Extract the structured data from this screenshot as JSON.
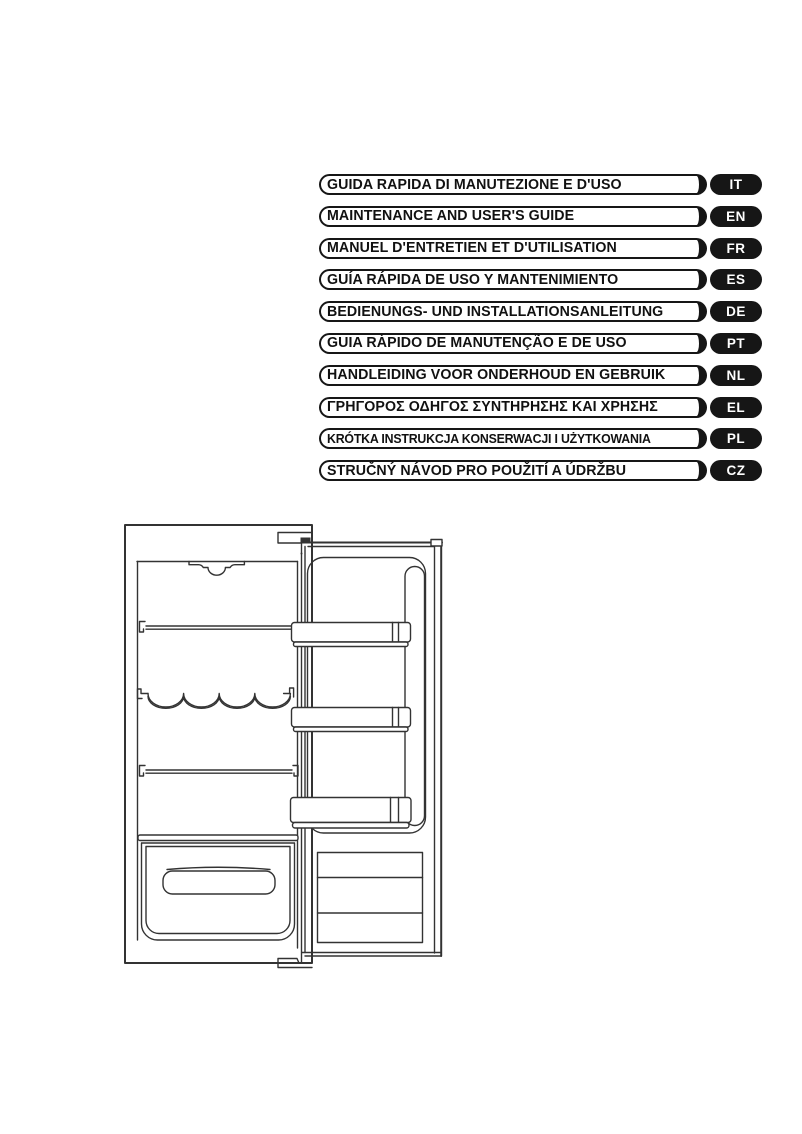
{
  "language_index": {
    "items": [
      {
        "title": "GUIDA RAPIDA DI MANUTEZIONE E D'USO",
        "code": "IT"
      },
      {
        "title": "MAINTENANCE AND USER'S GUIDE",
        "code": "EN"
      },
      {
        "title": "MANUEL D'ENTRETIEN ET D'UTILISATION",
        "code": "FR"
      },
      {
        "title": "GUÍA RÁPIDA DE USO Y MANTENIMIENTO",
        "code": "ES"
      },
      {
        "title": "BEDIENUNGS- UND INSTALLATIONSANLEITUNG",
        "code": "DE"
      },
      {
        "title": "GUIA RÁPIDO DE MANUTENÇÃO E DE USO",
        "code": "PT"
      },
      {
        "title": "HANDLEIDING VOOR ONDERHOUD EN GEBRUIK",
        "code": "NL"
      },
      {
        "title": "ΓΡΗΓΟΡΟΣ ΟΔΗΓΟΣ ΣΥΝΤΗΡΗΣΗΣ ΚΑΙ ΧΡΗΣΗΣ",
        "code": "EL"
      },
      {
        "title": "KRÓTKA INSTRUKCJA KONSERWACJI I UŻYTKOWANIA",
        "code": "PL"
      },
      {
        "title": "STRUČNÝ NÁVOD PRO POUŽITÍ A ÚDRŽBU",
        "code": "CZ"
      }
    ],
    "colors": {
      "bar_border": "#161616",
      "tag_background": "#161616",
      "tag_text": "#ffffff"
    }
  },
  "figure": {
    "name": "refrigerator-line-drawing",
    "description": "Front-view technical line drawing of a built-in refrigerator with open door: interior lamp housing, two wire shelves, wavy wine-bottle rack, crisper drawer with handle, three door bins and bottom ventilation grille",
    "line_color": "#333333"
  }
}
